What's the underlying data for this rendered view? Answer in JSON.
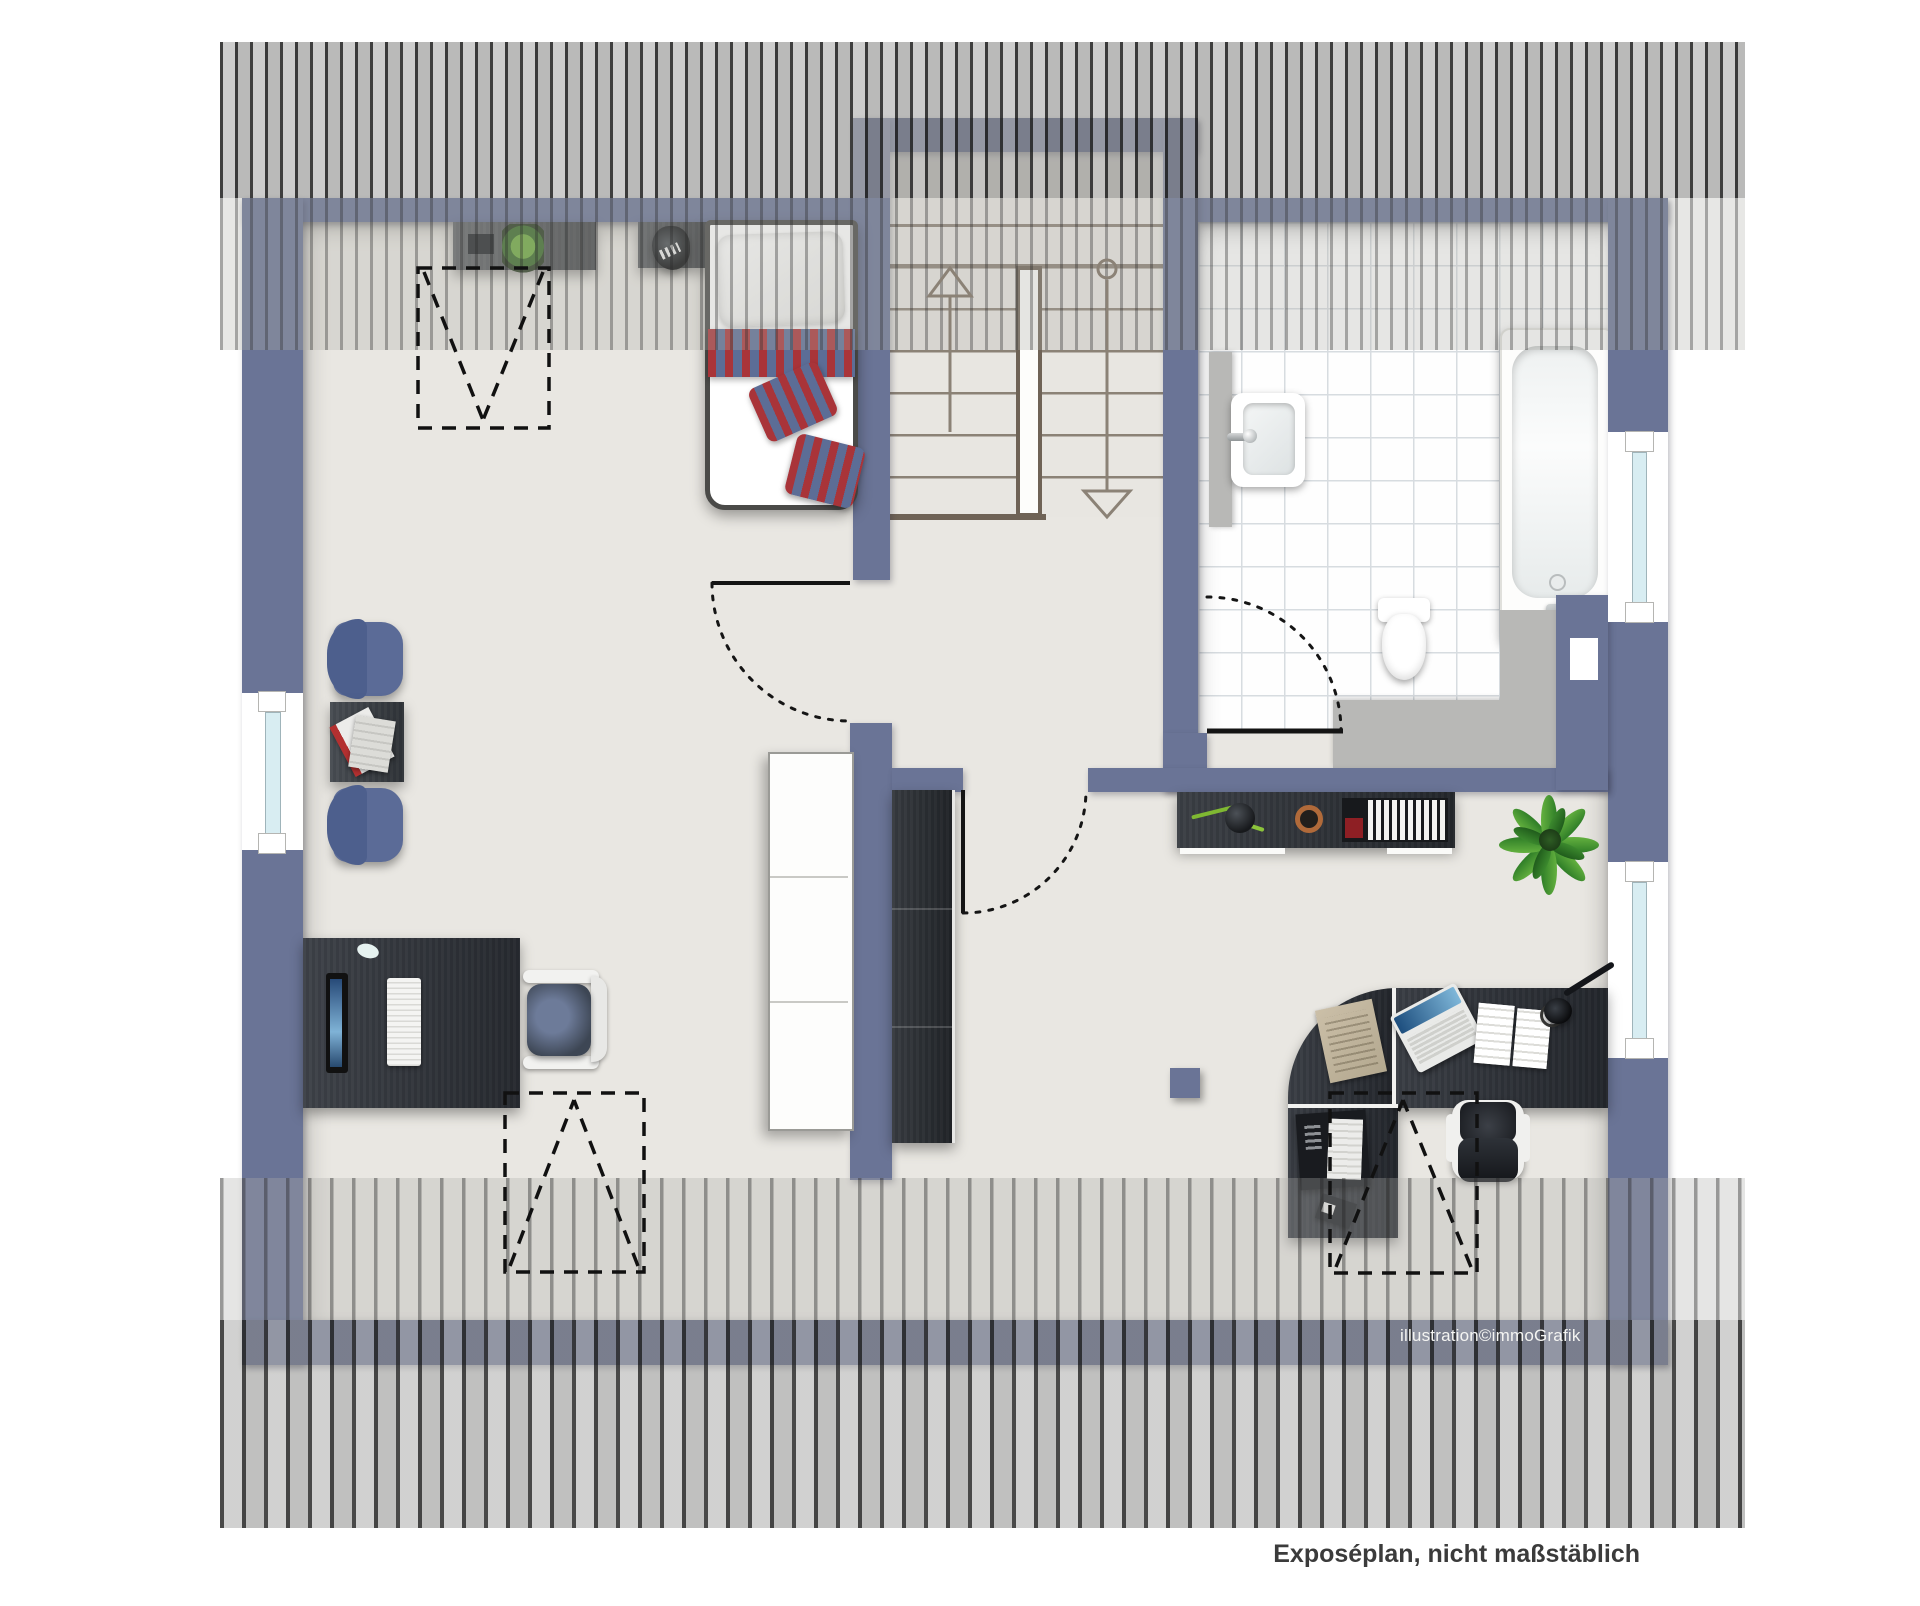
{
  "page": {
    "width": 1920,
    "height": 1606,
    "background": "#ffffff",
    "kind": "attic floor plan illustration"
  },
  "texts": {
    "credit": "illustration©immoGrafik",
    "disclaimer": "Exposéplan, nicht maßstäblich"
  },
  "colors": {
    "wall": "#6a7496",
    "floor": "#e9e7e2",
    "tile_line": "#d7dce0",
    "stair_tread": "#8b8276",
    "stair_trim": "#6f6356",
    "glass": "#d8edf2",
    "furniture_dark": "#2f333a",
    "chair_blue": "#5b6b97",
    "bed_stripe_red": "#a93439",
    "bed_stripe_blue": "#5c6d96",
    "plant_green": "#3f9a3c",
    "platform_gray": "#b8b8b6",
    "copper": "#b06a3a",
    "paper_beige": "#cbbfa8",
    "text_dark": "#3b3b3b",
    "text_light": "#f4f4f2"
  },
  "rooms": {
    "bedroom_office": {
      "furniture": [
        "wall sideboard with plant",
        "table lamp",
        "single bed with striped bedding",
        "armchair",
        "side table with magazines",
        "armchair",
        "computer desk",
        "desk chair",
        "roof window marker",
        "roof window marker",
        "west window"
      ]
    },
    "stair_hall": {
      "furniture": [
        "u-shaped staircase",
        "up arrow",
        "down arrow",
        "white wardrobe",
        "dark wardrobe"
      ]
    },
    "bathroom": {
      "furniture": [
        "wash basin",
        "toilet",
        "bathtub",
        "window",
        "platform"
      ]
    },
    "study": {
      "furniture": [
        "sideboard with vase, bowl and books",
        "potted plant",
        "corner desk with laptop, papers, lamp, letter tray, printer",
        "office swivel chair",
        "stool cube",
        "roof window marker",
        "window"
      ]
    }
  }
}
